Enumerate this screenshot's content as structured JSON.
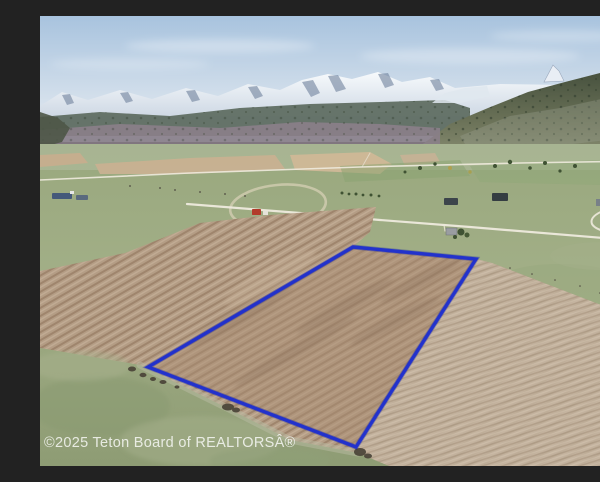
{
  "photo": {
    "kind": "aerial-drone-real-estate-photo",
    "scene": "Aerial view of a vacant plowed farmland parcel outlined in blue, in a rural valley with snow-capped mountains and a forested ridge in the background",
    "watermark": "©2025 Teton Board of REALTORSÂ®"
  },
  "parcel": {
    "label": "property-boundary",
    "points": "313,231 436,243 316,431 108,351",
    "outline_color": "#1e2ed0",
    "outline_shadow_color": "#0d1a9e",
    "outline_width": "3.4"
  },
  "colors": {
    "sky_top": "#a8c3de",
    "sky_horizon": "#dce5ee",
    "snow": "#f5f8fb",
    "rock": "#70829d",
    "forest_ridge": "#45503c",
    "foothills": "#8b7f8a",
    "pasture_green": "#95a37a",
    "field_brown": "#b49d85",
    "tan_field": "#c9b294",
    "road": "#eeeadd",
    "watermark_color": "rgba(255,255,255,0.78)"
  }
}
